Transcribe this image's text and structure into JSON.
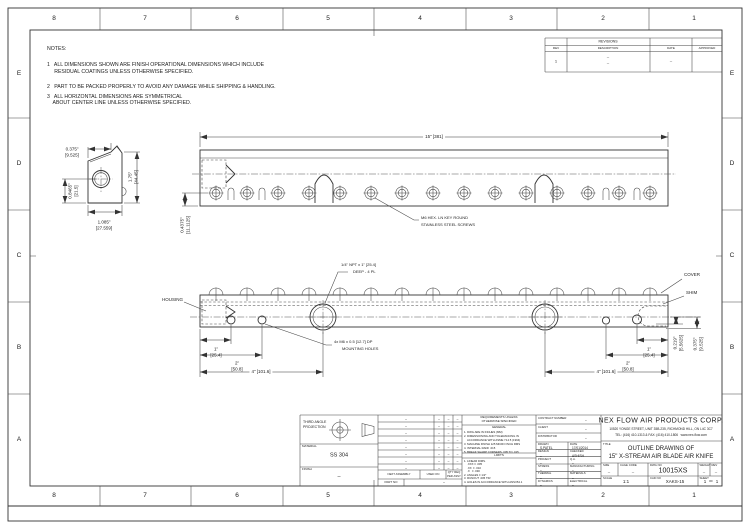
{
  "zones": {
    "cols": [
      "8",
      "7",
      "6",
      "5",
      "4",
      "3",
      "2",
      "1"
    ],
    "rows": [
      "E",
      "D",
      "C",
      "B",
      "A"
    ]
  },
  "notes": {
    "title": "NOTES:",
    "lines": [
      "1   ALL DIMENSIONS SHOWN ARE FINISH OPERATIONAL DIMENSIONS WHICH INCLUDE",
      "     RESIDUAL COATINGS UNLESS OTHERWISE SPECIFIED.",
      "2   PART TO BE PACKED PROPERLY TO AVOID ANY DAMAGE WHILE SHIPPING & HANDLING.",
      "3   ALL HORIZONTAL DIMENSIONS ARE SYMMETRICAL",
      "    ABOUT CENTER LINE UNLESS OTHERWISE SPECIFIED."
    ]
  },
  "revisions": {
    "title": "REVISIONS",
    "col_rev": "REV",
    "col_description": "DESCRIPTION",
    "col_date": "DATE",
    "col_approved": "APPROVED",
    "row": {
      "rev": "1",
      "description_line1": "–",
      "description_line2": "–",
      "date": "–",
      "approved": ""
    }
  },
  "side_view": {
    "dim_top": {
      "in": "0.375\"",
      "mm": "[9.525]"
    },
    "dim_right": {
      "in": "1.75\"",
      "mm": "[44.45]"
    },
    "dim_left": {
      "in": "0.8465\"",
      "mm": "[21.5]"
    },
    "dim_bottom": {
      "in": "1.085\"",
      "mm": "[27.559]"
    }
  },
  "top_view": {
    "dim_length": "15\" [381]",
    "dim_offset": {
      "in": "0.4375\"",
      "mm": "[11.1125]"
    },
    "screw_note_line1": "M6 HEX. LN KEY ROUND",
    "screw_note_line2": "STAINLESS STEEL SCREWS"
  },
  "front_view": {
    "npt_note_line1": "1/4\" NPT x 1\" [25.4]",
    "npt_note_line2": "DEEP - 4 PL",
    "label_housing": "HOUSING",
    "label_cover": "COVER",
    "label_shim": "SHIM",
    "mount_note_line1": "4x M6 x 0.5 [12.7] DP",
    "mount_note_line2": "MOUNTING HOLES",
    "dim_1_left": {
      "in": "1\"",
      "mm": "[25.4]"
    },
    "dim_2_left": {
      "in": "2\"",
      "mm": "[50.8]"
    },
    "dim_4_left": "4\" [101.6]",
    "dim_1_right": {
      "in": "1\"",
      "mm": "[25.4]"
    },
    "dim_2_right": {
      "in": "2\"",
      "mm": "[50.8]"
    },
    "dim_4_right": "4\" [101.6]",
    "dim_shim": {
      "in": "0.219\"",
      "mm": "[5.5625]"
    },
    "dim_gap": {
      "in": "0.375\"",
      "mm": "[9.525]"
    }
  },
  "title_block": {
    "projection_label_line1": "THIRD ANGLE",
    "projection_label_line2": "PROJECTION",
    "material_label": "MATERIAL",
    "material": "SS 304",
    "finish_label": "FINISH",
    "finish": "–",
    "parts": {
      "empty_marker": "–",
      "next_assembly_label": "NEXT ASSEMBLY",
      "used_on_label": "USED ON",
      "qty_label_line1": "QTY REQ",
      "qty_label_line2": "PER ASSY",
      "part_no_label": "PART NO",
      "part_no": "–"
    },
    "requirements": {
      "header_line1": "REQUIREMENTS UNLESS",
      "header_line2": "OTHERWISE SPECIFIED",
      "general_title": "GENERAL",
      "general_lines": [
        "1. DWG ARE IN INCHES (MM)",
        "2. DIMENSIONING AND TOLERANCING IN",
        "    ACCORDANCE WITH ASME Y14.5 (1994)",
        "3. MACHINE FINISH 125 MICRO INCH RMS",
        "4. INTERNAL RADII .015",
        "5. BREAK SHARP CORNERS .005 TO .015"
      ],
      "limits_title": "LIMITS",
      "limits_lines": [
        "1. LINEAR DIMS.",
        "    .XXX ± .005",
        "    .XX  ± .010",
        "    .X   ± .030",
        "2. ANGLES ± 1/2°",
        "3. RUNOUT .005 TIR",
        "4. HOLES IN ACCORDANCE WITH ANSI B4.1"
      ]
    },
    "admin": {
      "contract_label": "CONTRACT NUMBER",
      "contract": "–",
      "client_label": "CLIENT",
      "client": "–",
      "distributor_label": "DISTRIBUTOR",
      "distributor": "–",
      "drawn_label": "DRAWN",
      "drawn": "S.PATEL",
      "date_label": "DATE",
      "date": "17/01/2014",
      "design_label": "DESIGN",
      "design": "–",
      "checked_label": "CHECKED",
      "checked": "ASHISH",
      "project_label": "PROJECT",
      "project": "–",
      "qa_label": "Q.A.",
      "qa": "–",
      "stress_label": "STRESS",
      "stress": "–",
      "manufacturing_label": "MANUFACTURING",
      "manufacturing": "–",
      "thermal_label": "THERMAL",
      "thermal": "–",
      "materials_label": "MATERIALS",
      "materials": "–",
      "dynamics_label": "DYNAMICS",
      "dynamics": "–",
      "electrical_label": "ELECTRICAL",
      "electrical": "–"
    },
    "company": {
      "name": "NEX FLOW AIR PRODUCTS CORP.",
      "address": "10520 YONGE STREET, UNIT 35B-235, RICHMOND HILL, ON L4C 3C7",
      "contact": "TEL: (416) 410-1313 & FAX: (416) 410-1806   www.nex-flow.com"
    },
    "title_label": "TITLE",
    "title_line1": "OUTLINE DRAWING OF",
    "title_line2": "15\" X-STREAM AIR BLADE AIR KNIFE",
    "size_label": "SIZE",
    "size": "–",
    "cage_label": "CAGE CODE",
    "cage": "–",
    "dwg_label": "DWG NO",
    "dwg_no": "10015XS",
    "weight_label": "WEIGHT",
    "weight": "–",
    "rev_label": "REV",
    "rev": "–",
    "scale_label": "SCALE",
    "scale": "1:1",
    "cad_label": "CAD NO",
    "cad_no": "XAKS-15",
    "sheet_label": "SHEET",
    "sheet": "1",
    "of_label": "OF",
    "sheet_total": "1"
  }
}
